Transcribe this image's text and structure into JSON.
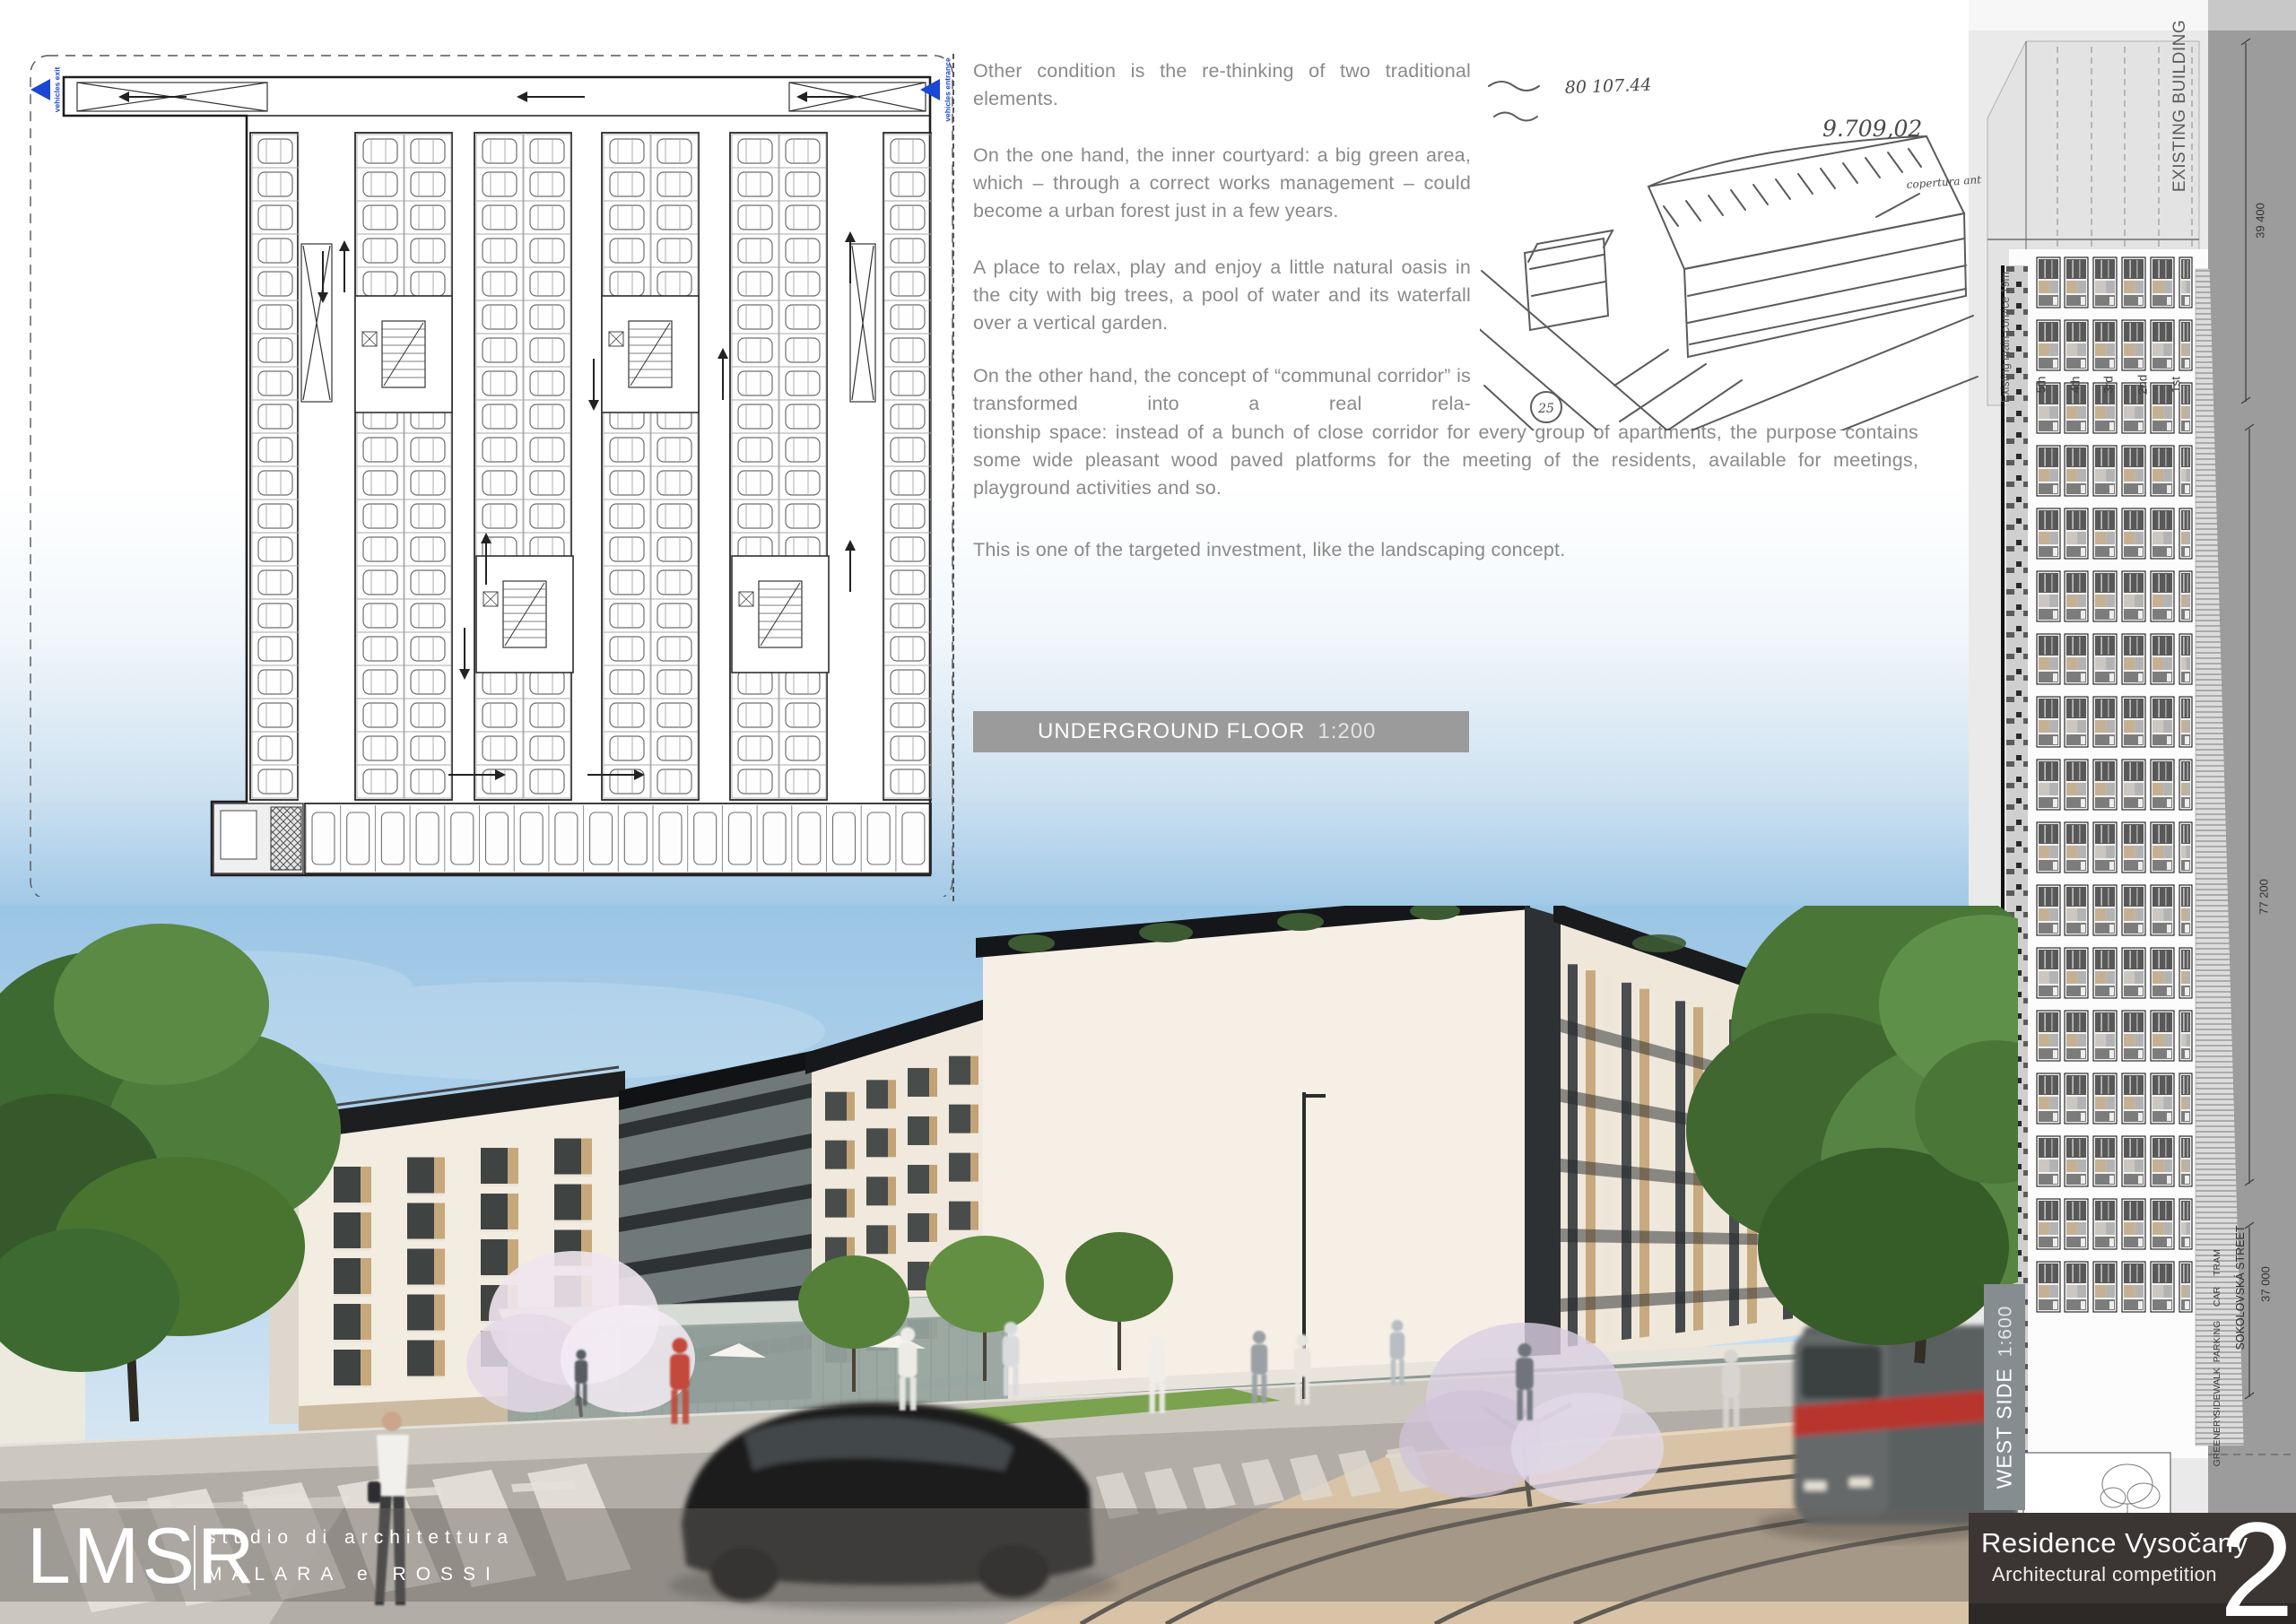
{
  "plan": {
    "label": "UNDERGROUND FLOOR",
    "scale": "1:200",
    "vehicles_exit": "vehicles exit",
    "vehicles_entrance": "vehicles entrance"
  },
  "essay": {
    "p1": "Other condition is the re-thinking of two traditional elements.",
    "p2": "On the one hand, the inner courtyard: a big green area, which – through a correct works management – could become a urban forest just in a few years.",
    "p3": "A place to relax, play and enjoy a little natural oasis in the city with big trees, a pool of water and its waterfall over a vertical garden.",
    "p4a": "On the other hand, the concept of “communal corridor” is transformed into a real rela-",
    "p4b": "tionship space: instead of a bunch of close corridor for every group of apartments, the purpose contains some wide pleasant wood paved platforms for the meeting of the residents, available for meetings, playground activities and so.",
    "p5": "This is one of the targeted investment, like the landscaping concept."
  },
  "sketch": {
    "ann_top": "80 107.44",
    "ann_num": "9.709,02",
    "ann_side": "copertura antica",
    "ann_circle": "25"
  },
  "elevation": {
    "existing_building": "EXISTING BUILDING",
    "floors": [
      "5th",
      "4th",
      "3rd",
      "2nd",
      "1st"
    ],
    "cornice": "Existing main cornice 19m",
    "dim_top": "39 400",
    "dim_mid": "77 200",
    "dim_bottom": "37 000",
    "street_labels": [
      "TRAM",
      "CAR",
      "PARKING",
      "SIDEWALK",
      "GREENERY"
    ],
    "street_name": "SOKOLOVSKÁ STREET",
    "west_side": "WEST SIDE",
    "west_scale": "1:600"
  },
  "logo": {
    "initials": "LMSR",
    "line1": "studio di architettura",
    "line2": "MALARA e ROSSI"
  },
  "footer": {
    "title": "Residence Vysočany",
    "subtitle": "Architectural competition",
    "number": "2"
  },
  "colors": {
    "accent_blue": "#1b46d6",
    "bar_gray": "#9b9b9b",
    "panel_dark": "#3b3534",
    "sky": "#a7cde9",
    "tan": "#c7a87c"
  }
}
